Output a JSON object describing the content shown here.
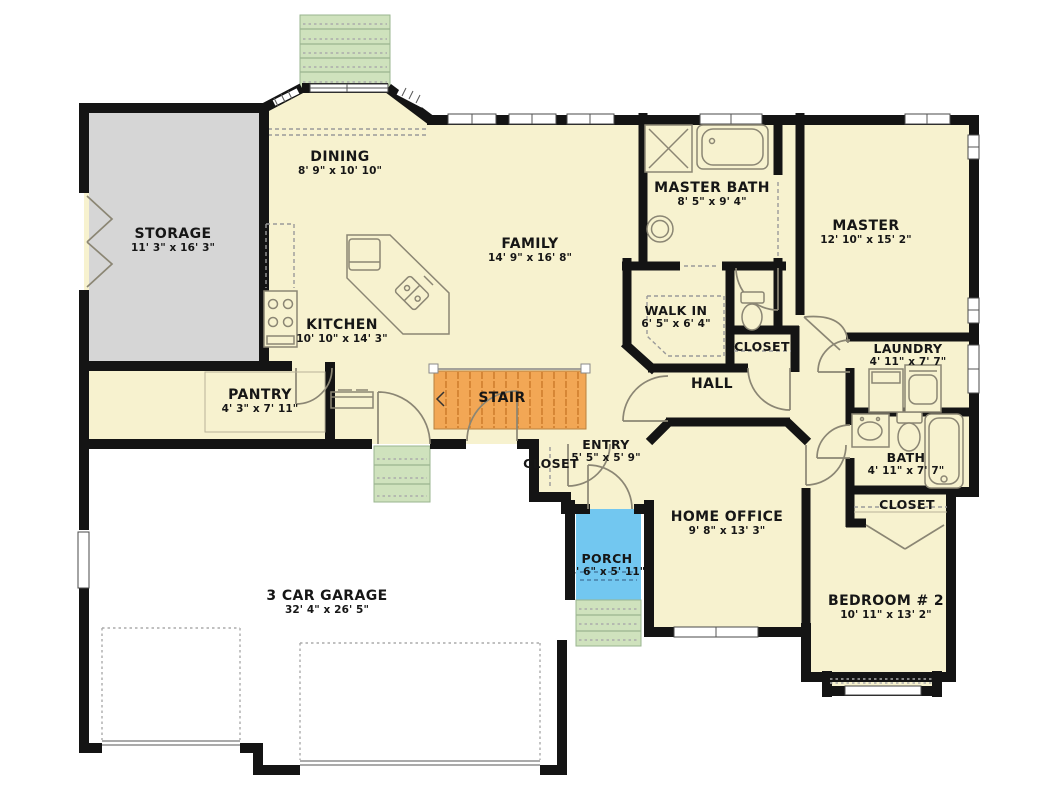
{
  "plan": {
    "title": "Single-story house floor plan",
    "colors": {
      "floor": "#f7f2cf",
      "storage": "#d6d6d6",
      "stair": "#f2a755",
      "porch": "#72c7f0",
      "steps": "#cfe2bd",
      "wall": "#141414"
    },
    "rooms": [
      {
        "name": "STORAGE",
        "dims": "11' 3\" x 16' 3\""
      },
      {
        "name": "DINING",
        "dims": "8' 9\" x 10' 10\""
      },
      {
        "name": "KITCHEN",
        "dims": "10' 10\" x 14' 3\""
      },
      {
        "name": "FAMILY",
        "dims": "14' 9\" x 16' 8\""
      },
      {
        "name": "MASTER BATH",
        "dims": "8' 5\" x 9' 4\""
      },
      {
        "name": "MASTER",
        "dims": "12' 10\" x 15' 2\""
      },
      {
        "name": "WALK IN",
        "dims": "6' 5\" x 6' 4\""
      },
      {
        "name": "CLOSET",
        "dims": ""
      },
      {
        "name": "HALL",
        "dims": ""
      },
      {
        "name": "LAUNDRY",
        "dims": "4' 11\" x 7' 7\""
      },
      {
        "name": "PANTRY",
        "dims": "4' 3\" x 7' 11\""
      },
      {
        "name": "STAIR",
        "dims": ""
      },
      {
        "name": "ENTRY",
        "dims": "5' 5\" x 5' 9\""
      },
      {
        "name": "CLOSET",
        "dims": ""
      },
      {
        "name": "BATH",
        "dims": "4' 11\" x 7' 7\""
      },
      {
        "name": "CLOSET",
        "dims": ""
      },
      {
        "name": "HOME OFFICE",
        "dims": "9' 8\" x 13' 3\""
      },
      {
        "name": "PORCH",
        "dims": "4' 6\" x 5' 11\""
      },
      {
        "name": "3 CAR GARAGE",
        "dims": "32' 4\" x 26' 5\""
      },
      {
        "name": "BEDROOM # 2",
        "dims": "10' 11\" x 13' 2\""
      }
    ]
  }
}
